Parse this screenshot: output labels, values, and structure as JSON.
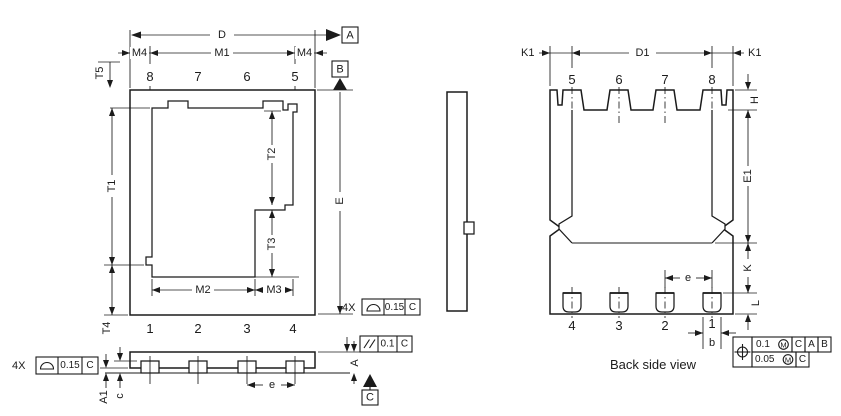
{
  "top_view": {
    "dims": {
      "D": "D",
      "M4": "M4",
      "M1": "M1",
      "T5": "T5",
      "T1": "T1",
      "T2": "T2",
      "T3": "T3",
      "T4": "T4",
      "M2": "M2",
      "M3": "M3",
      "E": "E"
    },
    "pins_top": [
      "8",
      "7",
      "6",
      "5"
    ],
    "pins_bottom": [
      "1",
      "2",
      "3",
      "4"
    ]
  },
  "front_view": {
    "dims": {
      "A": "A",
      "A1": "A1",
      "c": "c",
      "e": "e"
    }
  },
  "back_view": {
    "title": "Back side view",
    "dims": {
      "K1_left": "K1",
      "D1": "D1",
      "K1_right": "K1",
      "H": "H",
      "E1": "E1",
      "K": "K",
      "L": "L",
      "e": "e",
      "b": "b"
    },
    "pins_top": [
      "5",
      "6",
      "7",
      "8"
    ],
    "pins_bottom": [
      "4",
      "3",
      "2",
      "1"
    ]
  },
  "datums": {
    "A": "A",
    "B": "B",
    "C": "C"
  },
  "tolerances": {
    "profile_top": {
      "count": "4X",
      "value": "0.15",
      "datum": "C"
    },
    "profile_front": {
      "count": "4X",
      "value": "0.15",
      "datum": "C"
    },
    "parallelism": {
      "value": "0.1",
      "datum": "C"
    },
    "position": {
      "row1": {
        "value": "0.1",
        "modifier": "M",
        "datum_refs": [
          "C",
          "A",
          "B"
        ]
      },
      "row2": {
        "value": "0.05",
        "modifier": "M",
        "datum_refs": [
          "C"
        ]
      }
    }
  }
}
